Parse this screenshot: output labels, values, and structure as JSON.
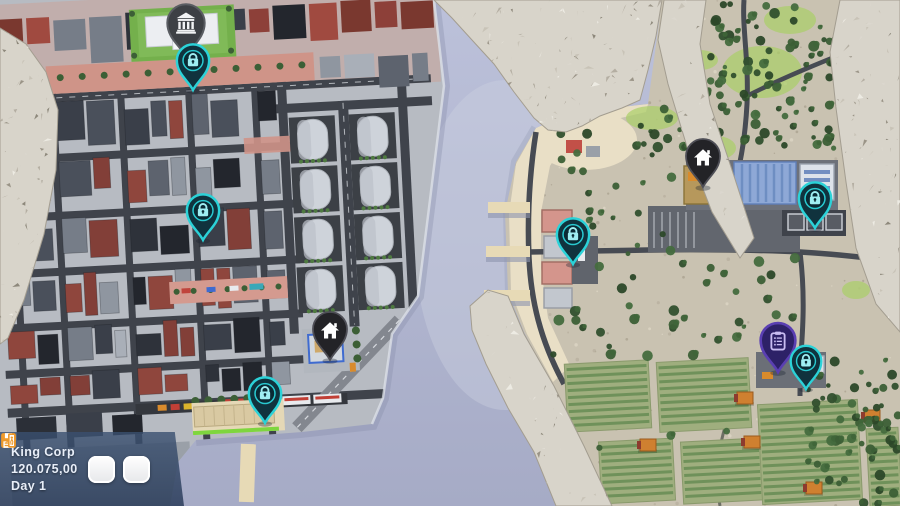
{
  "hud": {
    "company_name": "King Corp",
    "money": "120.075,00",
    "day": "Day 1",
    "buttons": [
      {
        "name": "save",
        "icon": "floppy-disk-icon"
      },
      {
        "name": "exit",
        "icon": "exit-door-icon"
      }
    ],
    "colors": {
      "panel": "#3a5070",
      "button_face": "#ffffff",
      "icon_accent": "#ef9a2b",
      "text": "#e8eef8"
    }
  },
  "map": {
    "pin_styles": {
      "locked-area": {
        "icon": "lock-icon",
        "fill": "#10333e",
        "border": "#2bd2d8",
        "icon_color": "#9feef2",
        "inner": "#0a2a34"
      },
      "headquarters": {
        "icon": "home-icon",
        "fill": "#232327",
        "border": "#4e4e56",
        "icon_color": "#ffffff",
        "inner": "#232327"
      },
      "bank": {
        "icon": "bank-building-icon",
        "fill": "#3d4045",
        "border": "#5a5d63",
        "icon_color": "#f2f3f5",
        "inner": "#3d4045"
      },
      "contracts": {
        "icon": "clipboard-icon",
        "fill": "#2d2167",
        "border": "#5a3fb2",
        "icon_color": "#c9bdf2",
        "inner": "#2d2167"
      }
    },
    "pins": [
      {
        "type": "bank",
        "x": 186,
        "y": 57,
        "scale": 1.1
      },
      {
        "type": "locked-area",
        "x": 193,
        "y": 90,
        "scale": 0.95
      },
      {
        "type": "locked-area",
        "x": 203,
        "y": 240,
        "scale": 0.95
      },
      {
        "type": "headquarters",
        "x": 330,
        "y": 360,
        "scale": 1.0
      },
      {
        "type": "locked-area",
        "x": 265,
        "y": 423,
        "scale": 0.95
      },
      {
        "type": "headquarters",
        "x": 703,
        "y": 187,
        "scale": 1.0
      },
      {
        "type": "locked-area",
        "x": 815,
        "y": 228,
        "scale": 0.95
      },
      {
        "type": "locked-area",
        "x": 573,
        "y": 264,
        "scale": 0.95
      },
      {
        "type": "contracts",
        "x": 778,
        "y": 372,
        "scale": 1.02
      },
      {
        "type": "locked-area",
        "x": 806,
        "y": 389,
        "scale": 0.9
      }
    ]
  },
  "scene_colors": {
    "water": "#b3b8d2",
    "city_ground": "#b7bbc2",
    "countryside": "#c9c2b1",
    "beach": "#e9dfc6",
    "rock": "#d8d4ca",
    "field": "#9fae7e",
    "road": "#474b53"
  }
}
